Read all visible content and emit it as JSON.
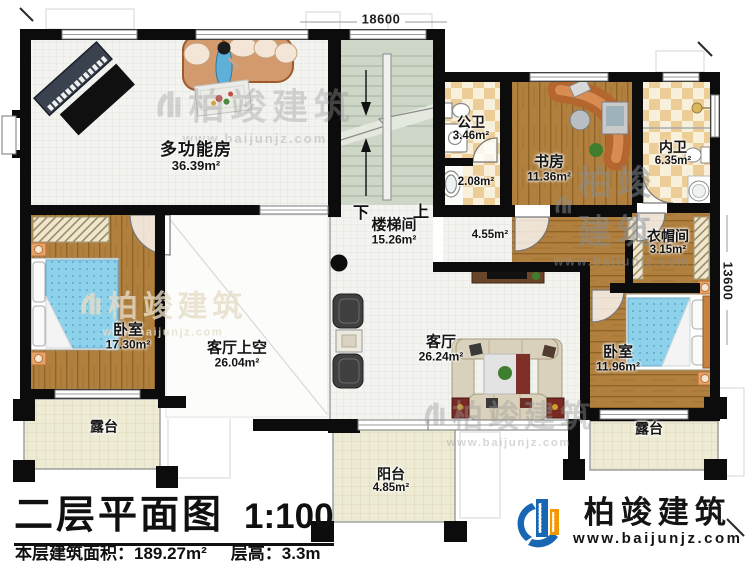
{
  "plan_title": {
    "name": "二层平面图",
    "scale": "1:100"
  },
  "info": {
    "area_label": "本层建筑面积：",
    "area_value": "189.27m²",
    "height_label": "层高：",
    "height_value": "3.3m"
  },
  "dimensions": {
    "top": "18600",
    "right": "13600"
  },
  "stairs": {
    "down": "下",
    "up": "上"
  },
  "rooms": [
    {
      "id": "multi-function",
      "name": "多功能房",
      "area": "36.39m²"
    },
    {
      "id": "public-bath",
      "name": "公卫",
      "area": "3.46m²"
    },
    {
      "id": "wash-area",
      "name": "",
      "area": "2.08m²"
    },
    {
      "id": "study",
      "name": "书房",
      "area": "11.36m²"
    },
    {
      "id": "inner-bath",
      "name": "内卫",
      "area": "6.35m²"
    },
    {
      "id": "cloakroom",
      "name": "衣帽间",
      "area": "3.15m²"
    },
    {
      "id": "stairwell",
      "name": "楼梯间",
      "area": "15.26m²"
    },
    {
      "id": "hallway",
      "name": "",
      "area": "4.55m²"
    },
    {
      "id": "bedroom-left",
      "name": "卧室",
      "area": "17.30m²"
    },
    {
      "id": "living-void",
      "name": "客厅上空",
      "area": "26.04m²"
    },
    {
      "id": "living-room",
      "name": "客厅",
      "area": "26.24m²"
    },
    {
      "id": "bedroom-right",
      "name": "卧室",
      "area": "11.96m²"
    },
    {
      "id": "terrace-left",
      "name": "露台",
      "area": ""
    },
    {
      "id": "terrace-right",
      "name": "露台",
      "area": ""
    },
    {
      "id": "balcony",
      "name": "阳台",
      "area": "4.85m²"
    }
  ],
  "brand": {
    "name": "柏竣建筑",
    "url": "www.baijunjz.com"
  },
  "watermark": {
    "text": "柏竣建筑",
    "url": "www.baijunjz.com"
  },
  "colors": {
    "wall": "#0c0c0c",
    "wood": "#b1803e",
    "tile_bath": "#eccd96",
    "stair": "#ced6c8",
    "terrace": "#eeebd4",
    "brand_blue": "#1767b3",
    "brand_orange": "#f39800",
    "bed_blue": "#8ed1ea"
  }
}
